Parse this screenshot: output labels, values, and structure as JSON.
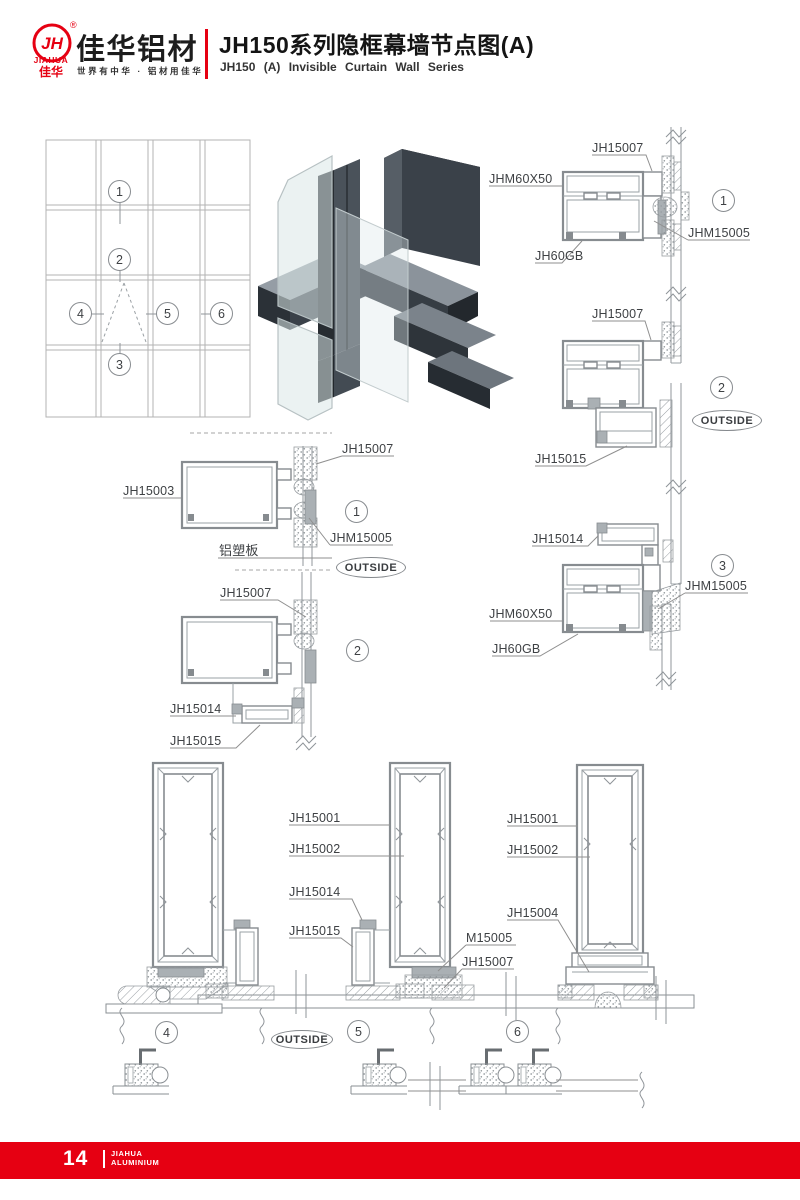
{
  "brand": {
    "monogram": "JH",
    "registered": "®",
    "name_en": "JIAHUA",
    "name_cn": "佳华",
    "company": "佳华铝材",
    "tagline": "世界有中华 · 铝材用佳华",
    "red": "#e60012"
  },
  "header": {
    "title": "JH150系列隐框幕墙节点图(A)",
    "subtitle": "JH150 (A) Invisible Curtain Wall Series"
  },
  "footer": {
    "page": "14",
    "line1": "JIAHUA",
    "line2": "ALUMINIUM"
  },
  "elevation": {
    "markers": [
      "1",
      "2",
      "3",
      "4",
      "5",
      "6"
    ]
  },
  "details": {
    "right1": {
      "marker": "1",
      "labels": {
        "top": "JH15007",
        "left": "JHM60X50",
        "bottom": "JH60GB",
        "right": "JHM15005"
      }
    },
    "right2": {
      "marker": "2",
      "outside": "OUTSIDE",
      "labels": {
        "top": "JH15007",
        "bottom": "JH15015"
      }
    },
    "right3": {
      "marker": "3",
      "labels": {
        "top": "JH15014",
        "right": "JHM15005",
        "left": "JHM60X50",
        "bottom": "JH60GB"
      }
    },
    "left1": {
      "marker": "1",
      "outside": "OUTSIDE",
      "labels": {
        "left": "JH15003",
        "top": "JH15007",
        "right": "JHM15005",
        "panel": "铝塑板"
      }
    },
    "left2": {
      "marker": "2",
      "labels": {
        "top": "JH15007",
        "mid": "JH15014",
        "bottom": "JH15015"
      }
    },
    "bottom": {
      "markers": [
        "4",
        "5",
        "6"
      ],
      "outside": "OUTSIDE",
      "mid": [
        "JH15001",
        "JH15002",
        "JH15014",
        "JH15015"
      ],
      "right": [
        "JH15001",
        "JH15002",
        "JH15004",
        "M15005",
        "JH15007"
      ]
    }
  }
}
